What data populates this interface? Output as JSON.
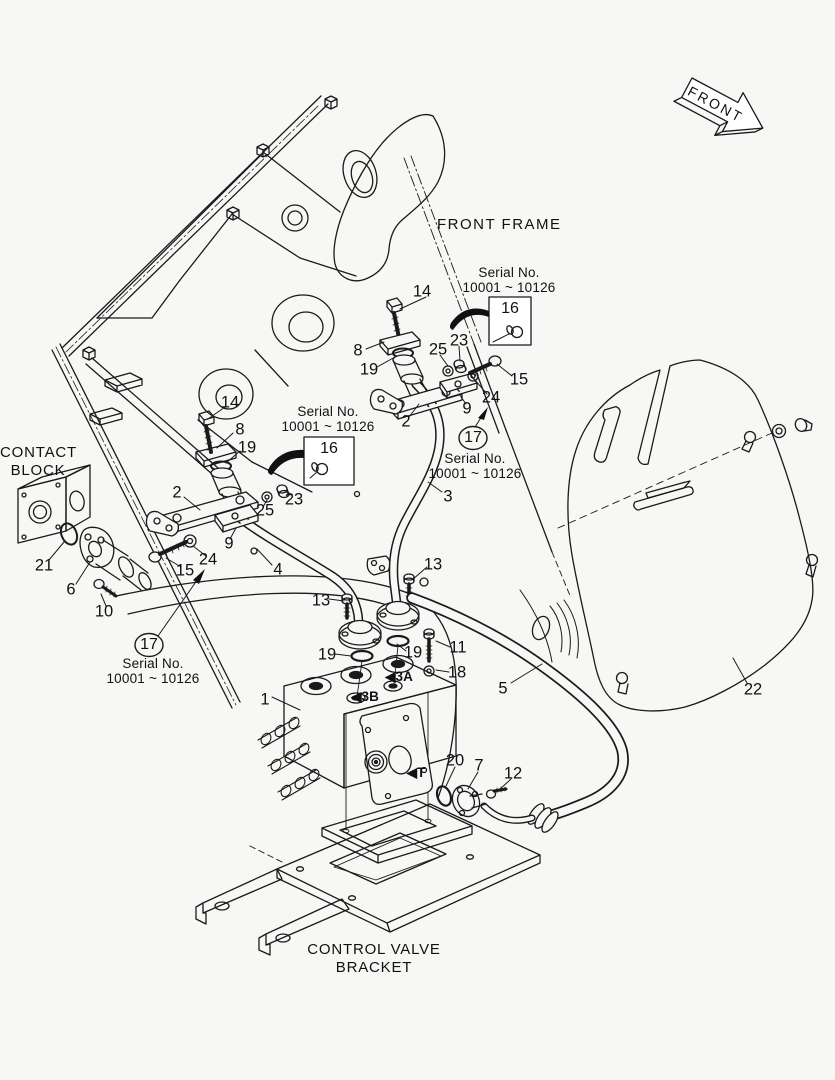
{
  "annotations": {
    "front_frame": "FRONT FRAME",
    "contact_block_1": "CONTACT",
    "contact_block_2": "BLOCK",
    "control_valve_bracket_1": "CONTROL VALVE",
    "control_valve_bracket_2": "BRACKET",
    "front_arrow": "FRONT"
  },
  "serial_notes": [
    {
      "placement": "upper-right",
      "line1": "Serial No.",
      "line2": "10001 ~ 10126",
      "ref": "16",
      "marker": "boxed"
    },
    {
      "placement": "middle-left",
      "line1": "Serial No.",
      "line2": "10001 ~ 10126",
      "ref": "16",
      "marker": "boxed"
    },
    {
      "placement": "middle-right",
      "line1": "Serial No.",
      "line2": "10001 ~ 10126",
      "ref": "17",
      "marker": "circled"
    },
    {
      "placement": "lower-left",
      "line1": "Serial No.",
      "line2": "10001 ~ 10126",
      "ref": "17",
      "marker": "circled"
    }
  ],
  "callouts": [
    {
      "n": "14",
      "x": 422,
      "y": 292
    },
    {
      "n": "8",
      "x": 358,
      "y": 351
    },
    {
      "n": "19",
      "x": 369,
      "y": 370
    },
    {
      "n": "25",
      "x": 438,
      "y": 350
    },
    {
      "n": "23",
      "x": 459,
      "y": 341
    },
    {
      "n": "15",
      "x": 519,
      "y": 380
    },
    {
      "n": "24",
      "x": 491,
      "y": 398
    },
    {
      "n": "9",
      "x": 467,
      "y": 409
    },
    {
      "n": "2",
      "x": 406,
      "y": 422
    },
    {
      "n": "3",
      "x": 448,
      "y": 497
    },
    {
      "n": "14",
      "x": 230,
      "y": 403
    },
    {
      "n": "8",
      "x": 240,
      "y": 430
    },
    {
      "n": "19",
      "x": 247,
      "y": 448
    },
    {
      "n": "2",
      "x": 177,
      "y": 493
    },
    {
      "n": "23",
      "x": 294,
      "y": 500
    },
    {
      "n": "25",
      "x": 265,
      "y": 511
    },
    {
      "n": "9",
      "x": 229,
      "y": 544
    },
    {
      "n": "24",
      "x": 208,
      "y": 560
    },
    {
      "n": "15",
      "x": 185,
      "y": 571
    },
    {
      "n": "4",
      "x": 278,
      "y": 570
    },
    {
      "n": "21",
      "x": 44,
      "y": 566
    },
    {
      "n": "6",
      "x": 71,
      "y": 590
    },
    {
      "n": "10",
      "x": 104,
      "y": 612
    },
    {
      "n": "13",
      "x": 321,
      "y": 601
    },
    {
      "n": "13",
      "x": 433,
      "y": 565
    },
    {
      "n": "19",
      "x": 327,
      "y": 655
    },
    {
      "n": "19",
      "x": 413,
      "y": 653
    },
    {
      "n": "11",
      "x": 458,
      "y": 648
    },
    {
      "n": "18",
      "x": 457,
      "y": 673
    },
    {
      "n": "1",
      "x": 265,
      "y": 700
    },
    {
      "n": "5",
      "x": 503,
      "y": 689
    },
    {
      "n": "20",
      "x": 455,
      "y": 761
    },
    {
      "n": "7",
      "x": 479,
      "y": 766
    },
    {
      "n": "12",
      "x": 513,
      "y": 774
    },
    {
      "n": "22",
      "x": 753,
      "y": 690
    },
    {
      "n": "3A",
      "x": 399,
      "y": 677,
      "style": "port",
      "prefix": "◀"
    },
    {
      "n": "3B",
      "x": 365,
      "y": 697,
      "style": "port",
      "prefix": "◀"
    },
    {
      "n": "T",
      "x": 416,
      "y": 773,
      "style": "port",
      "prefix": "◀"
    }
  ]
}
